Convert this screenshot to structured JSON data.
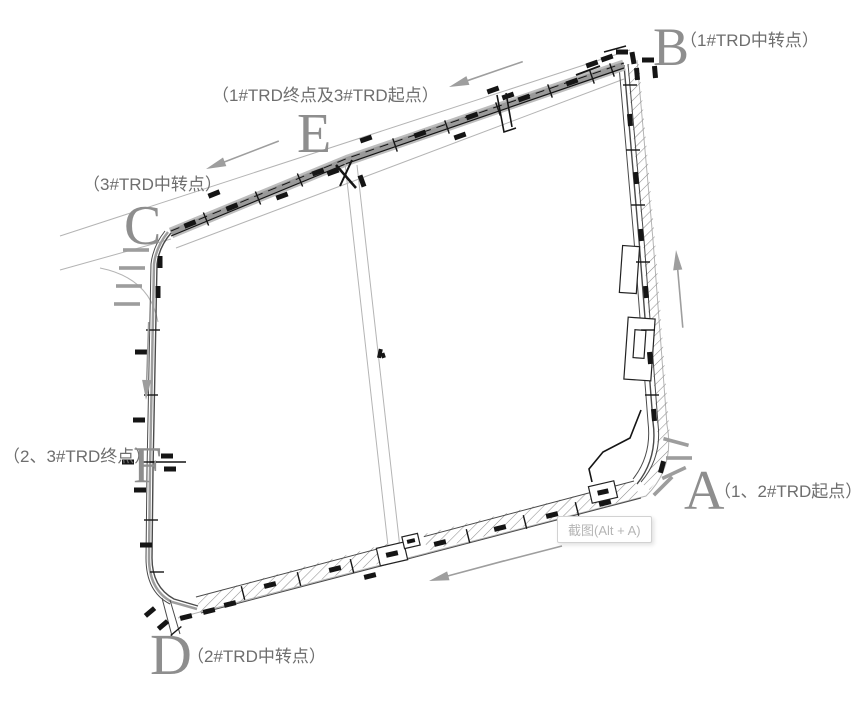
{
  "colors": {
    "background": "#ffffff",
    "line": "#4a4a4a",
    "band": "#9d9d9d",
    "hatch": "#8f8f8f",
    "thin": "#b4b4b4",
    "arrow": "#9e9e9e",
    "letter": "#8e8e8e",
    "note": "#6e6e6e",
    "mark": "#151515",
    "tooltip_text": "#b5b5b5",
    "tooltip_border": "#d2d2d2"
  },
  "points": [
    {
      "letter": "A",
      "note": "（1、2#TRD起点）"
    },
    {
      "letter": "B",
      "note": "（1#TRD中转点）"
    },
    {
      "letter": "C",
      "note": "（3#TRD中转点）"
    },
    {
      "letter": "D",
      "note": "（2#TRD中转点）"
    },
    {
      "letter": "E",
      "note": "（1#TRD终点及3#TRD起点）"
    },
    {
      "letter": "F",
      "note": "（2、3#TRD终点）"
    }
  ],
  "screenshot_hint": {
    "text": "截图(Alt + A)"
  }
}
